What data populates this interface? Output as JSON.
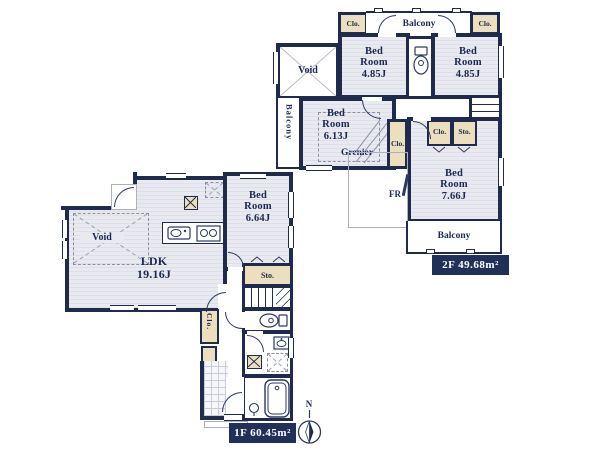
{
  "palette": {
    "wall": "#1e2b4e",
    "floor": "#e9e9f0",
    "closet_beige": "#ecdfbd",
    "area_label_bg": "#203058",
    "area_label_text": "#ffffff"
  },
  "meta": {
    "compass_label": "N"
  },
  "f2": {
    "area": "2F 49.68m²",
    "balcony_top": "Balcony",
    "balcony_left": "Balcony",
    "balcony_bottom": "Balcony",
    "clo_tl": "Clo.",
    "clo_tr": "Clo.",
    "clo_mid": "Clo.",
    "clo_in": "Clo.",
    "sto_in": "Sto.",
    "void": "Void",
    "grenier": "Grenier",
    "fr": "FR",
    "bed_tl": {
      "l1": "Bed",
      "l2": "Room",
      "size": "4.85J"
    },
    "bed_tr": {
      "l1": "Bed",
      "l2": "Room",
      "size": "4.85J"
    },
    "bed_613": {
      "l1": "Bed",
      "l2": "Room",
      "size": "6.13J"
    },
    "bed_766": {
      "l1": "Bed",
      "l2": "Room",
      "size": "7.66J"
    }
  },
  "f1": {
    "area": "1F 60.45m²",
    "ldk": {
      "l1": "LDK",
      "size": "19.16J"
    },
    "void": "Void",
    "bed": {
      "l1": "Bed",
      "l2": "Room",
      "size": "6.64J"
    },
    "sto": "Sto.",
    "clo": "Clo."
  }
}
